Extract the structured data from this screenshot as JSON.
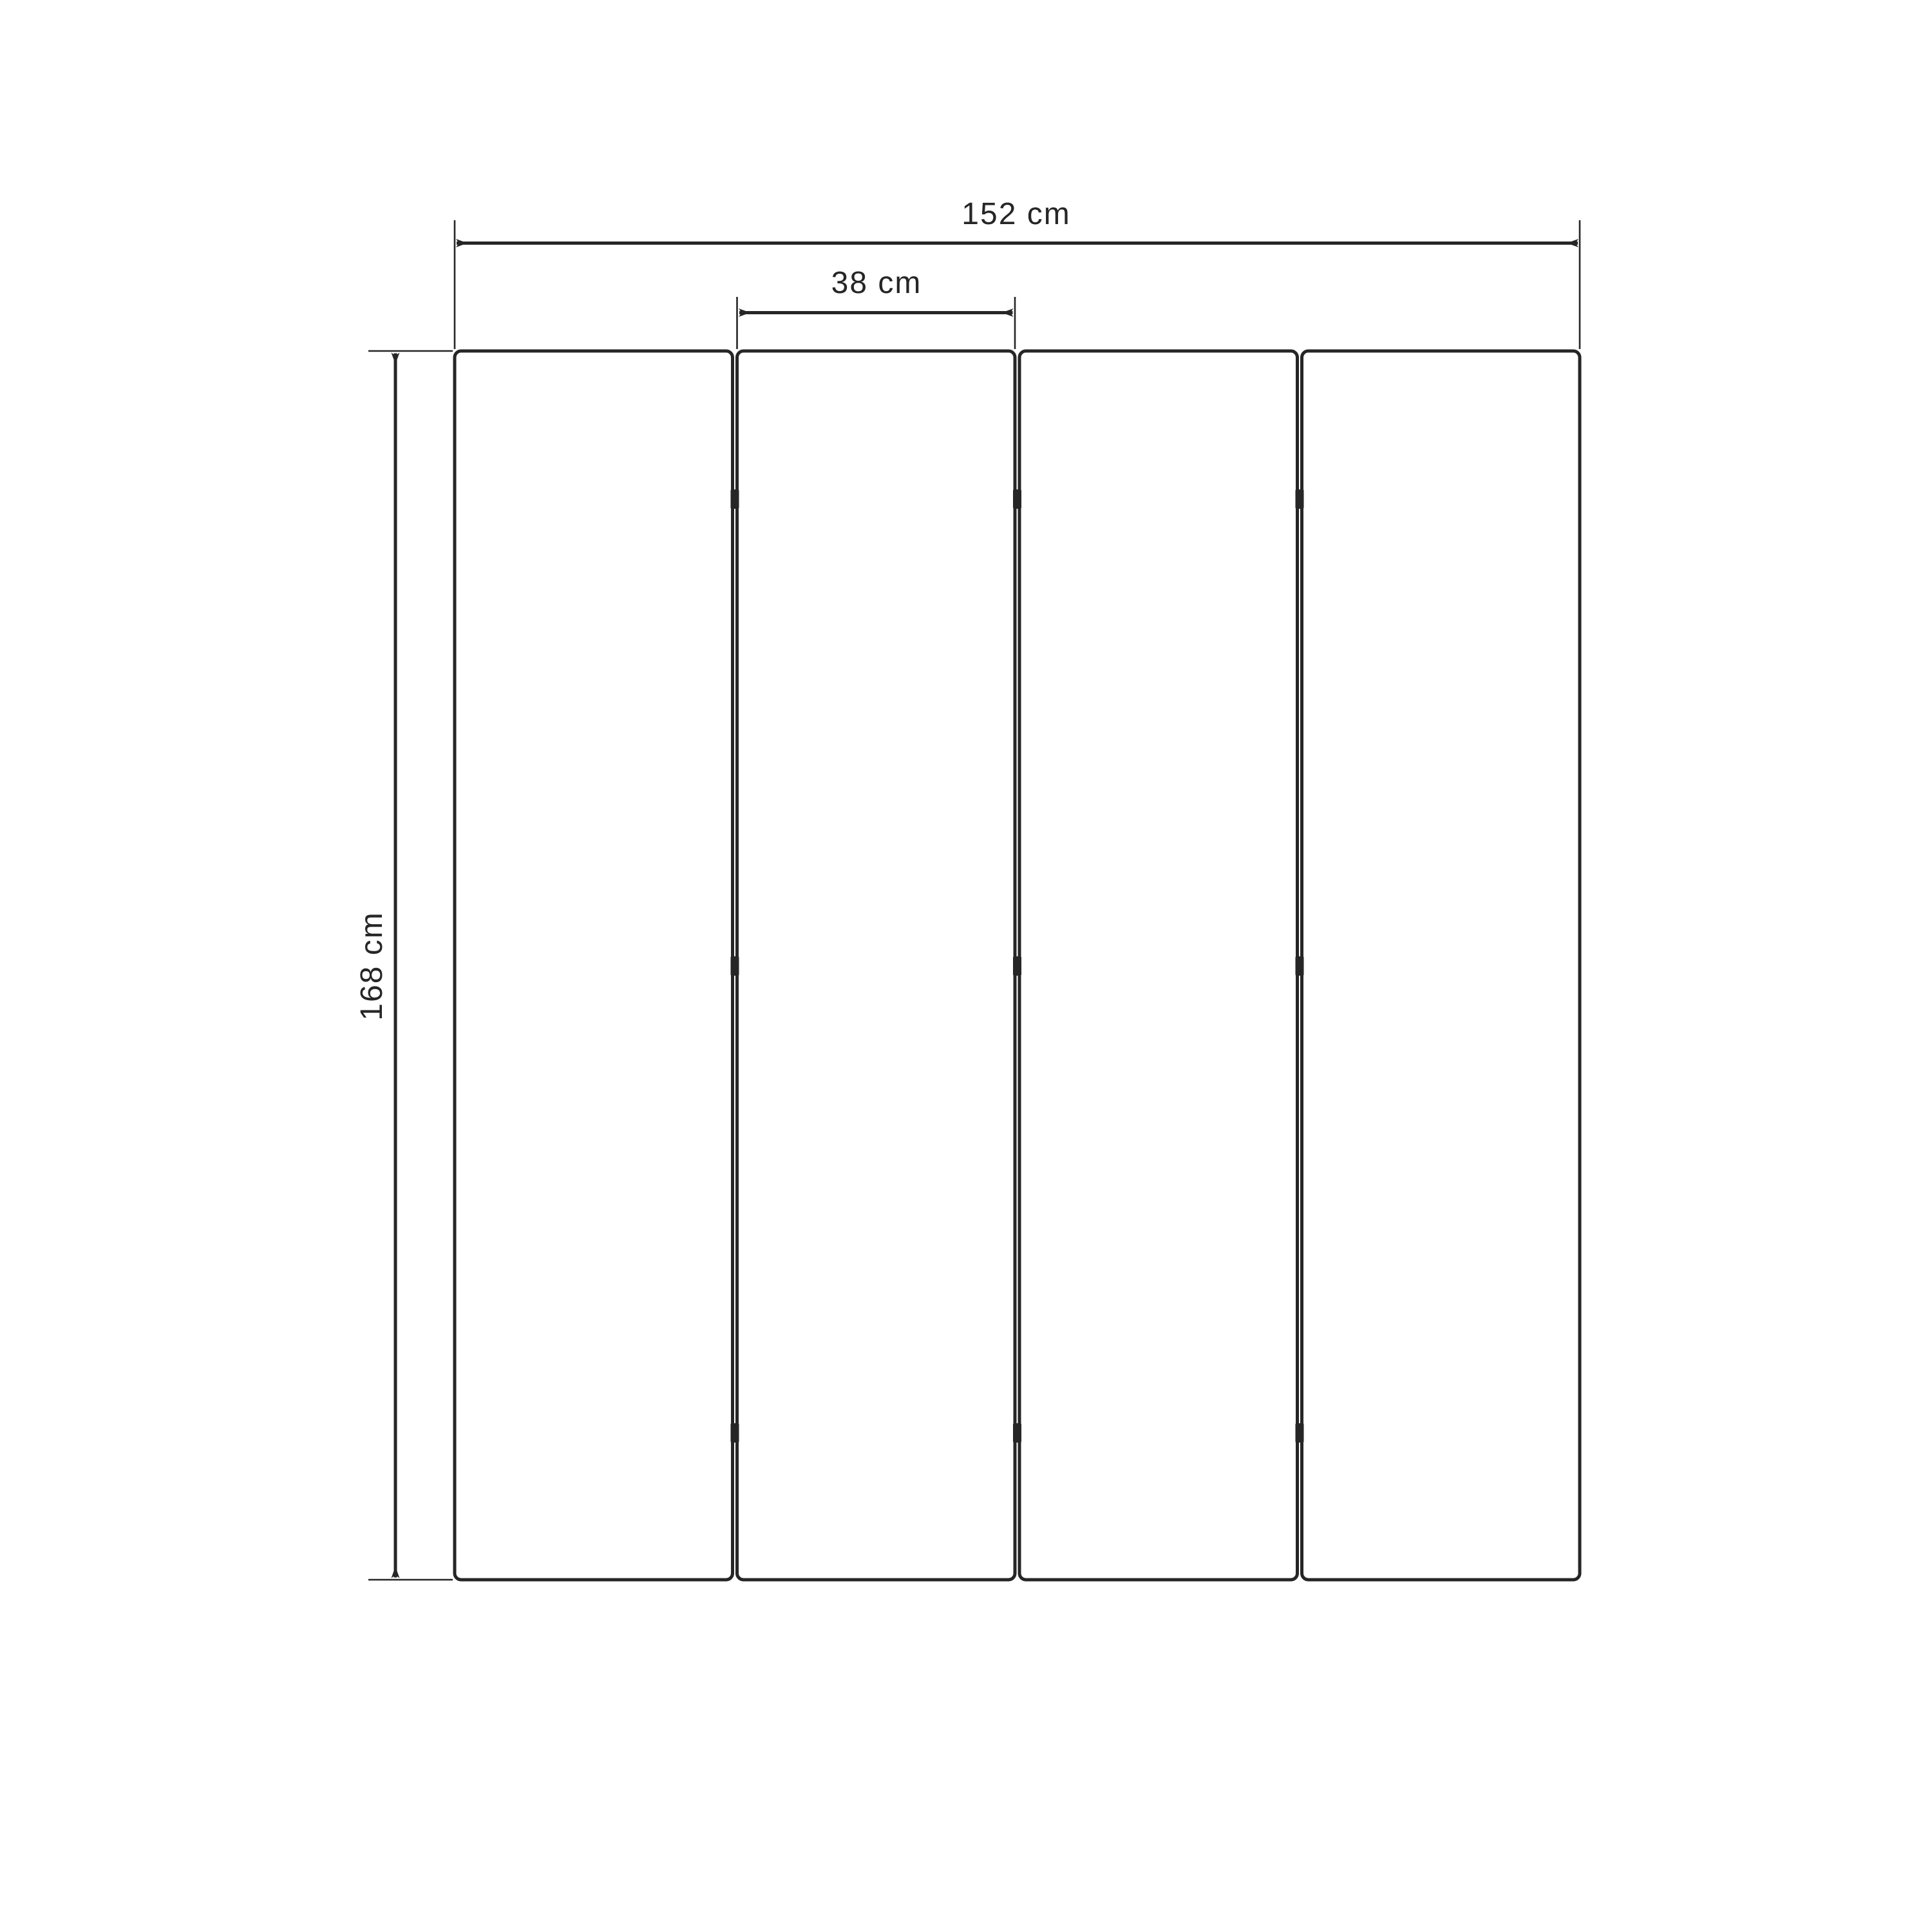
{
  "diagram": {
    "type": "folding-screen-dimension-diagram",
    "background_color": "#ffffff",
    "ink_color": "#262626",
    "panel_count": 4,
    "hinge_rows_per_gap": 3,
    "dimensions": {
      "total_width": {
        "label": "152 cm"
      },
      "panel_width": {
        "label": "38 cm"
      },
      "height": {
        "label": "168 cm"
      }
    }
  }
}
